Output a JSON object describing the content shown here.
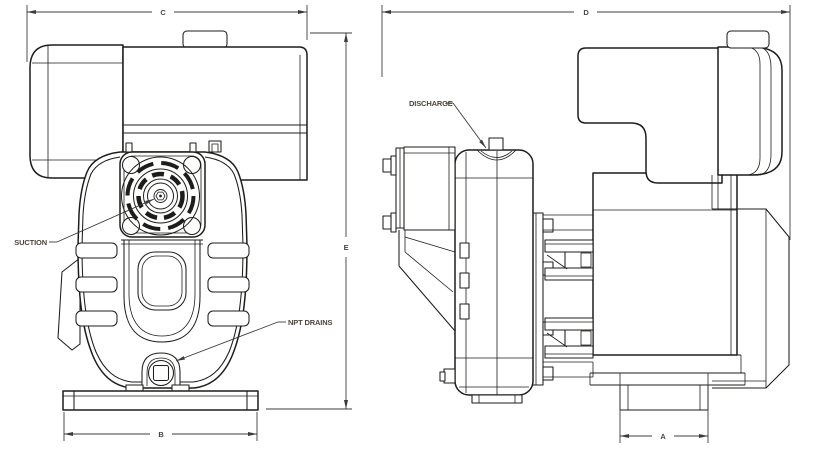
{
  "drawing": {
    "front_view": {
      "dim_top": "C",
      "dim_right": "E",
      "dim_bottom": "B",
      "label_suction": "SUCTION",
      "label_npt_drains": "NPT DRAINS"
    },
    "side_view": {
      "dim_top": "D",
      "dim_bottom": "A",
      "label_discharge": "DISCHARGE"
    },
    "colors": {
      "line": "#1d1d1b",
      "text": "#4a463c",
      "background": "#ffffff"
    }
  }
}
